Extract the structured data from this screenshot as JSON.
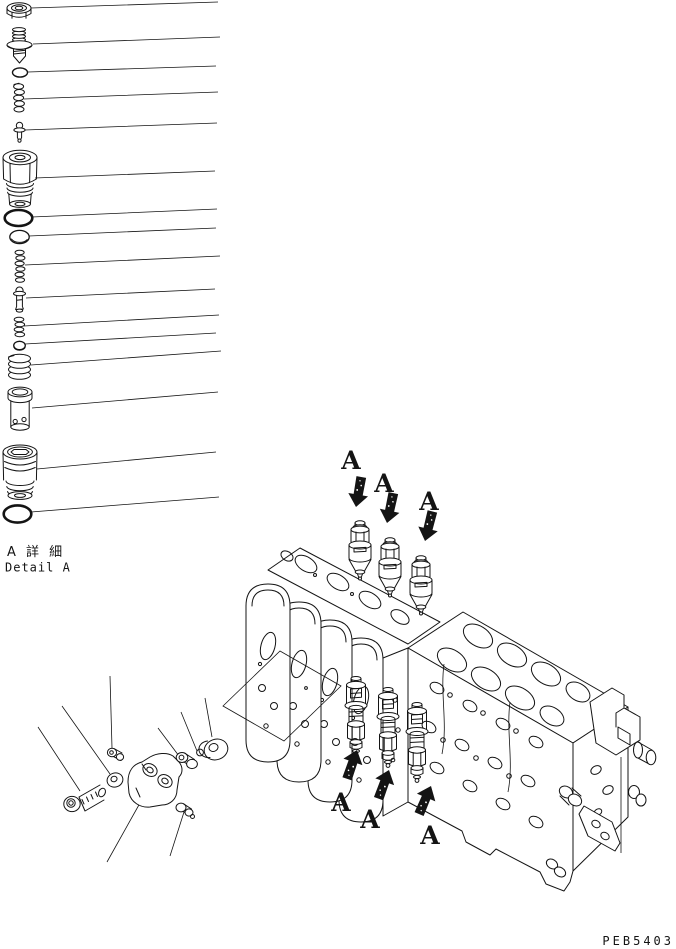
{
  "page": {
    "background_color": "#ffffff",
    "ink_color": "#141414",
    "drawing_code": "PEB5403"
  },
  "detail_view": {
    "caption_jp": "A 詳 細",
    "caption_en": "Detail A",
    "parts": [
      {
        "icon": "hex-nut-icon"
      },
      {
        "icon": "threaded-plug-icon"
      },
      {
        "icon": "small-o-ring-icon"
      },
      {
        "icon": "spring-icon"
      },
      {
        "icon": "poppet-valve-icon"
      },
      {
        "icon": "relief-valve-body-icon"
      },
      {
        "icon": "thick-o-ring-icon"
      },
      {
        "icon": "backup-ring-icon"
      },
      {
        "icon": "spring-icon"
      },
      {
        "icon": "poppet-valve-icon"
      },
      {
        "icon": "small-spring-icon"
      },
      {
        "icon": "washer-icon"
      },
      {
        "icon": "coil-spring-icon"
      },
      {
        "icon": "valve-sleeve-icon"
      },
      {
        "icon": "main-valve-body-icon"
      },
      {
        "icon": "large-o-ring-icon"
      }
    ]
  },
  "assembly_view": {
    "marker": "A",
    "top_markers": [
      "A",
      "A",
      "A"
    ],
    "bottom_markers": [
      "A",
      "A",
      "A"
    ],
    "arrow_color": "#141414"
  }
}
